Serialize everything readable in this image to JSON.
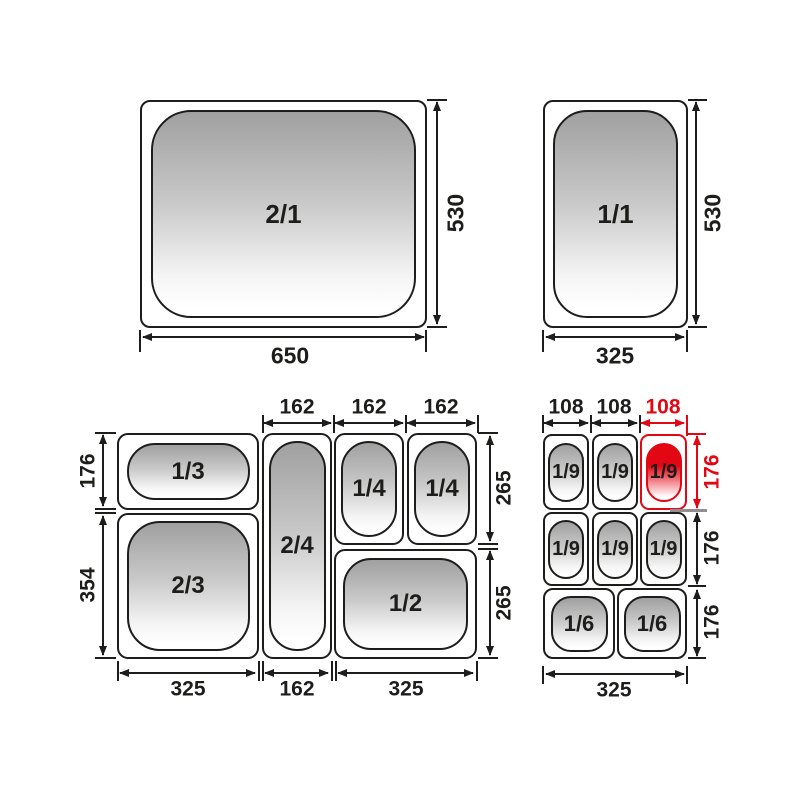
{
  "diagram": {
    "type": "gastronorm-pan-size-chart",
    "colors": {
      "line": "#1d1d1b",
      "highlight": "#e30613"
    },
    "gn21": {
      "label": "2/1",
      "bottom_dim": "650",
      "side_dim": "530"
    },
    "gn11": {
      "label": "1/1",
      "bottom_dim": "325",
      "side_dim": "530"
    },
    "combo_left": {
      "cells": [
        {
          "label": "1/3"
        },
        {
          "label": "2/3"
        },
        {
          "label": "2/4"
        },
        {
          "label": "1/4"
        },
        {
          "label": "1/4"
        },
        {
          "label": "1/2"
        }
      ],
      "top_dims": [
        "162",
        "162",
        "162"
      ],
      "left_dims": [
        "176",
        "354"
      ],
      "right_dims": [
        "265",
        "265"
      ],
      "bottom_dims": [
        "325",
        "162",
        "325"
      ]
    },
    "combo_right": {
      "cells": [
        {
          "label": "1/9"
        },
        {
          "label": "1/9"
        },
        {
          "label": "1/9",
          "highlighted": true
        },
        {
          "label": "1/9"
        },
        {
          "label": "1/9"
        },
        {
          "label": "1/9"
        },
        {
          "label": "1/6"
        },
        {
          "label": "1/6"
        }
      ],
      "top_dims": [
        "108",
        "108",
        "108"
      ],
      "top_dims_highlighted_index": 2,
      "right_dims": [
        "176",
        "176",
        "176"
      ],
      "right_dims_highlighted_index": 0,
      "bottom_dims": [
        "325"
      ]
    }
  }
}
